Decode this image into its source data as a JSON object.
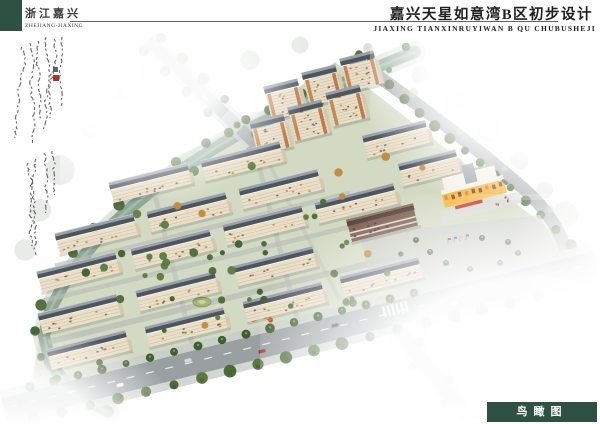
{
  "header": {
    "block_color": "#2e5141",
    "region_cn": "浙江嘉兴",
    "region_en": "ZHEJIANG·JIAXING",
    "title_cn": "嘉兴天星如意湾B区初步设计",
    "title_en": "JIAXING TIANXINRUYIWAN B QU CHUBUSHEJI"
  },
  "annotation": {
    "kind": "vertical handwritten calligraphy inscription (illegible grass script)",
    "ink_color": "#4a4a4a",
    "seal_color": "#b03224"
  },
  "footer": {
    "view_label_cn": "鸟瞰图",
    "box_color": "#2e5141",
    "text_color": "#ffffff"
  },
  "scene": {
    "description": "bird's-eye architectural rendering of residential district with canal, tree-lined roads, slab apartment rows, high-rise cluster, commercial block and kindergarten",
    "colors": {
      "grass": "#97a86f",
      "water": "#8ea796",
      "bank": "#cdd5c6",
      "road": "#9aa0a2",
      "sidewalk": "#c9cdcb",
      "path": "#b9bdb7",
      "roof_front": "#4f555d",
      "roof_top": "#99a0aa",
      "facade": "#eadfc9",
      "gable": "#d6c8ae",
      "tree_dark": "#3f5e2f",
      "tree_mid": "#4c6b38",
      "tree_light": "#5a7a42",
      "tree_autumn": "#c08b3c",
      "veg_faded": "#c2cdbd",
      "commercial_brown": "#7d5c4e",
      "commercial_brown_roof": "#564138",
      "kindergarten_yellow": "#f5b540",
      "kindergarten_white": "#f7f3ea",
      "accent_red": "#c23b2a",
      "window_dark": "#6f6152",
      "window_orange": "#c08447"
    },
    "slabs": [
      [
        114,
        203
      ],
      [
        206,
        181
      ],
      [
        60,
        254
      ],
      [
        152,
        232
      ],
      [
        244,
        209
      ],
      [
        42,
        292
      ],
      [
        136,
        269
      ],
      [
        228,
        245
      ],
      [
        320,
        223
      ],
      [
        43,
        334
      ],
      [
        141,
        311
      ],
      [
        239,
        286
      ],
      [
        52,
        370
      ],
      [
        150,
        347
      ],
      [
        248,
        322
      ],
      [
        345,
        297
      ]
    ],
    "slab_len": 80,
    "slab_h": 13,
    "towers": [
      [
        272,
        120
      ],
      [
        310,
        106
      ],
      [
        348,
        92
      ],
      [
        258,
        155
      ],
      [
        296,
        141
      ],
      [
        334,
        126
      ]
    ],
    "tower_len": 34,
    "tower_h": 26,
    "midrise": [
      [
        368,
        158,
        64
      ],
      [
        404,
        186,
        58
      ]
    ],
    "angle_deg": -14
  }
}
